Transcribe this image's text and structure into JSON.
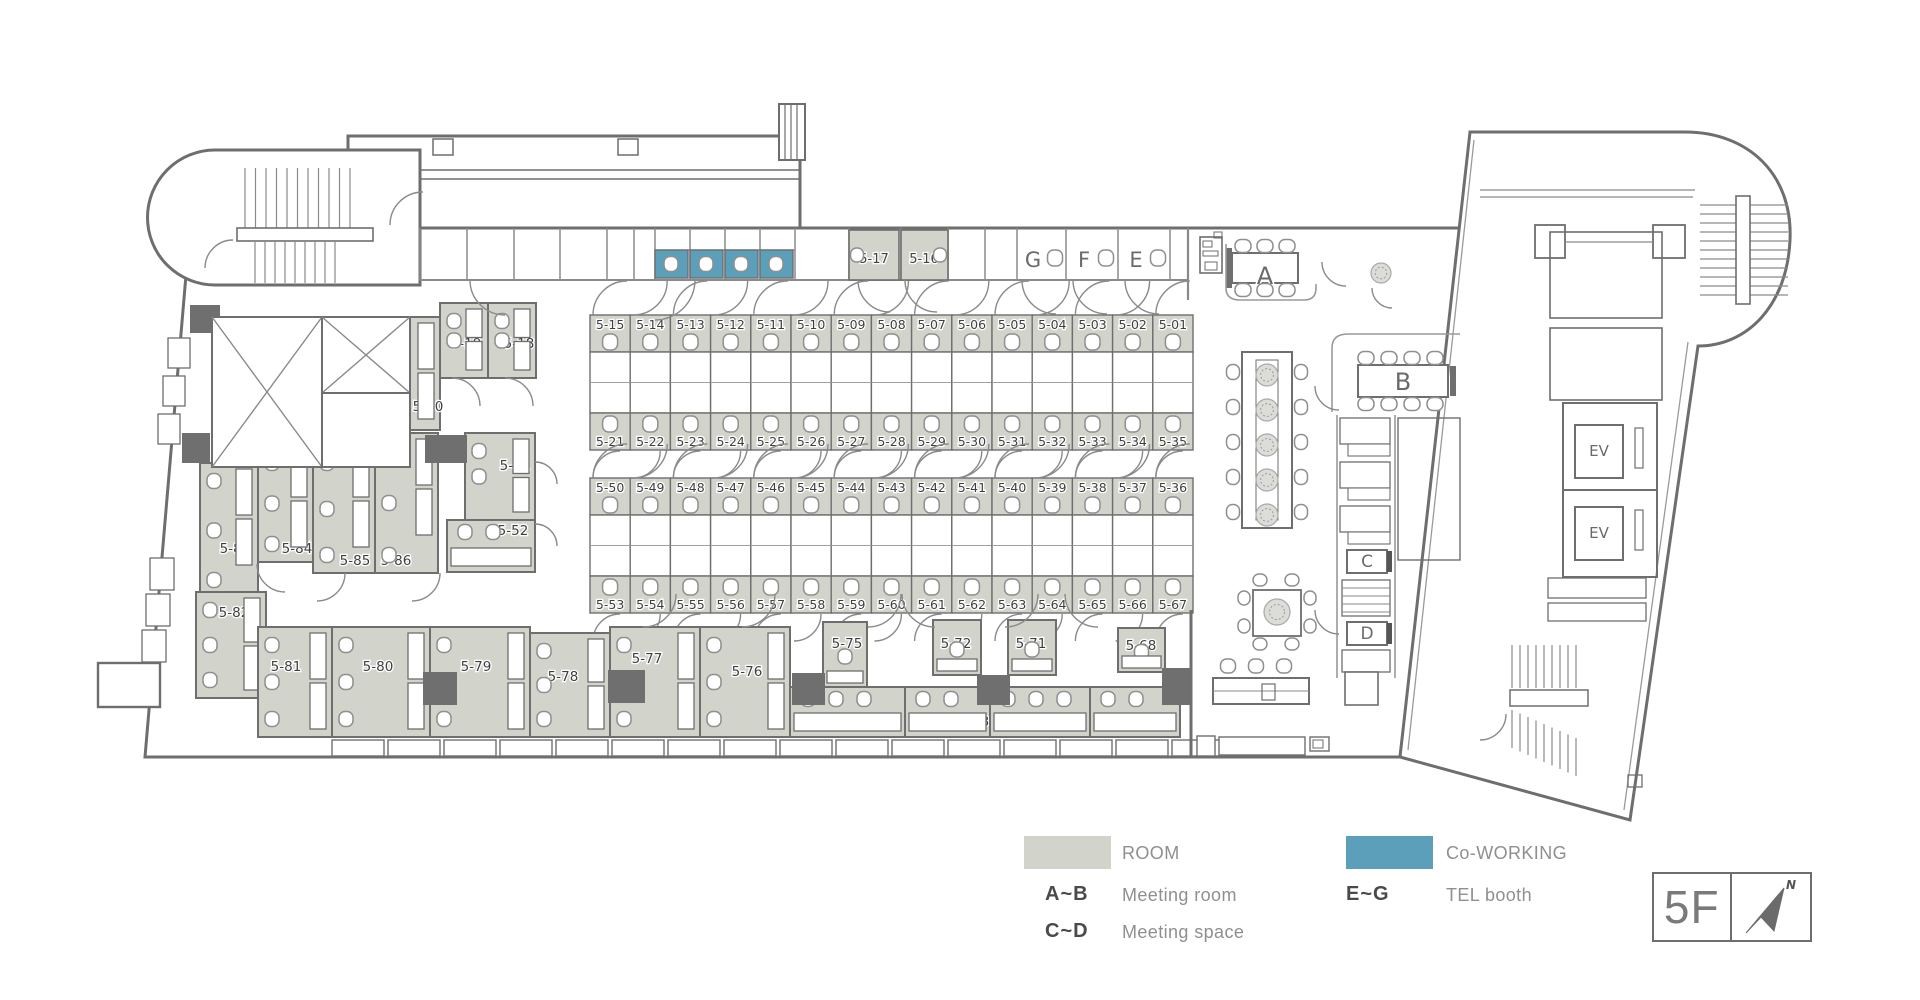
{
  "colors": {
    "room": "#d2d4cc",
    "coworking": "#5b9fba",
    "wall": "#6e6e6e",
    "dark_block": "#6f6f6f",
    "label": "#3f3f3f"
  },
  "floor_badge": {
    "floor": "5F",
    "north": "N"
  },
  "legend": {
    "room_label": "ROOM",
    "coworking_label": "Co-WORKING",
    "meeting_room_key": "A~B",
    "meeting_room_label": "Meeting room",
    "meeting_space_key": "C~D",
    "meeting_space_label": "Meeting space",
    "tel_booth_key": "E~G",
    "tel_booth_label": "TEL booth"
  },
  "cubicles": {
    "block1_top": [
      "5-15",
      "5-14",
      "5-13",
      "5-12",
      "5-11",
      "5-10",
      "5-09",
      "5-08",
      "5-07",
      "5-06",
      "5-05",
      "5-04",
      "5-03",
      "5-02",
      "5-01"
    ],
    "block1_bottom": [
      "5-21",
      "5-22",
      "5-23",
      "5-24",
      "5-25",
      "5-26",
      "5-27",
      "5-28",
      "5-29",
      "5-30",
      "5-31",
      "5-32",
      "5-33",
      "5-34",
      "5-35"
    ],
    "block2_top": [
      "5-50",
      "5-49",
      "5-48",
      "5-47",
      "5-46",
      "5-45",
      "5-44",
      "5-43",
      "5-42",
      "5-41",
      "5-40",
      "5-39",
      "5-38",
      "5-37",
      "5-36"
    ],
    "block2_bottom": [
      "5-53",
      "5-54",
      "5-55",
      "5-56",
      "5-57",
      "5-58",
      "5-59",
      "5-60",
      "5-61",
      "5-62",
      "5-63",
      "5-64",
      "5-65",
      "5-66",
      "5-67"
    ]
  },
  "strip_rooms": [
    "5-17",
    "5-16"
  ],
  "tel_booths": [
    "G",
    "F",
    "E"
  ],
  "meeting_rooms": [
    "A",
    "B"
  ],
  "meeting_spaces": [
    "C",
    "D"
  ],
  "elevator_label": "EV",
  "offices": [
    {
      "id": "5-19",
      "x": 440,
      "y": 303,
      "w": 48,
      "h": 75,
      "lx": 26,
      "ly": 40,
      "style": "office"
    },
    {
      "id": "5-18",
      "x": 488,
      "y": 303,
      "w": 48,
      "h": 75,
      "lx": 31,
      "ly": 40,
      "style": "office"
    },
    {
      "id": "5-20",
      "x": 378,
      "y": 317,
      "w": 62,
      "h": 113,
      "lx": 50,
      "ly": 89,
      "style": "office"
    },
    {
      "id": "5-51",
      "x": 465,
      "y": 433,
      "w": 70,
      "h": 87,
      "lx": 50,
      "ly": 32,
      "style": "office"
    },
    {
      "id": "5-52",
      "x": 447,
      "y": 520,
      "w": 88,
      "h": 52,
      "lx": 66,
      "ly": 10,
      "style": "band"
    },
    {
      "id": "5-83",
      "x": 200,
      "y": 463,
      "w": 58,
      "h": 135,
      "lx": 35,
      "ly": 85,
      "style": "office"
    },
    {
      "id": "5-84",
      "x": 258,
      "y": 445,
      "w": 55,
      "h": 117,
      "lx": 39,
      "ly": 103,
      "style": "office"
    },
    {
      "id": "5-85",
      "x": 313,
      "y": 445,
      "w": 62,
      "h": 128,
      "lx": 42,
      "ly": 115,
      "style": "office"
    },
    {
      "id": "5-86",
      "x": 375,
      "y": 433,
      "w": 63,
      "h": 140,
      "lx": 21,
      "ly": 127,
      "style": "office"
    },
    {
      "id": "5-82",
      "x": 196,
      "y": 592,
      "w": 70,
      "h": 106,
      "lx": 38,
      "ly": 20,
      "style": "office"
    },
    {
      "id": "5-81",
      "x": 258,
      "y": 627,
      "w": 74,
      "h": 110,
      "lx": 28,
      "ly": 39,
      "style": "office"
    },
    {
      "id": "5-80",
      "x": 332,
      "y": 627,
      "w": 98,
      "h": 110,
      "lx": 46,
      "ly": 39,
      "style": "office"
    },
    {
      "id": "5-79",
      "x": 430,
      "y": 627,
      "w": 100,
      "h": 110,
      "lx": 46,
      "ly": 39,
      "style": "office"
    },
    {
      "id": "5-78",
      "x": 530,
      "y": 633,
      "w": 80,
      "h": 104,
      "lx": 33,
      "ly": 43,
      "style": "office"
    },
    {
      "id": "5-77",
      "x": 610,
      "y": 627,
      "w": 90,
      "h": 110,
      "lx": 37,
      "ly": 31,
      "style": "office"
    },
    {
      "id": "5-76",
      "x": 700,
      "y": 627,
      "w": 90,
      "h": 110,
      "lx": 47,
      "ly": 44,
      "style": "office"
    },
    {
      "id": "5-75",
      "x": 823,
      "y": 622,
      "w": 44,
      "h": 65,
      "lx": 24,
      "ly": 21,
      "style": "booth"
    },
    {
      "id": "5-74",
      "x": 790,
      "y": 687,
      "w": 115,
      "h": 50,
      "lx": 24,
      "ly": 34,
      "style": "band"
    },
    {
      "id": "5-72",
      "x": 933,
      "y": 620,
      "w": 48,
      "h": 55,
      "lx": 23,
      "ly": 23,
      "style": "booth"
    },
    {
      "id": "5-71",
      "x": 1008,
      "y": 620,
      "w": 48,
      "h": 55,
      "lx": 23,
      "ly": 23,
      "style": "booth"
    },
    {
      "id": "5-73",
      "x": 905,
      "y": 687,
      "w": 85,
      "h": 50,
      "lx": 69,
      "ly": 34,
      "style": "band"
    },
    {
      "id": "5-70",
      "x": 990,
      "y": 687,
      "w": 100,
      "h": 50,
      "lx": 22,
      "ly": 34,
      "style": "band"
    },
    {
      "id": "5-68",
      "x": 1118,
      "y": 628,
      "w": 47,
      "h": 44,
      "lx": 23,
      "ly": 17,
      "style": "booth"
    },
    {
      "id": "5-69",
      "x": 1090,
      "y": 687,
      "w": 90,
      "h": 50,
      "lx": 68,
      "ly": 34,
      "style": "band"
    }
  ]
}
